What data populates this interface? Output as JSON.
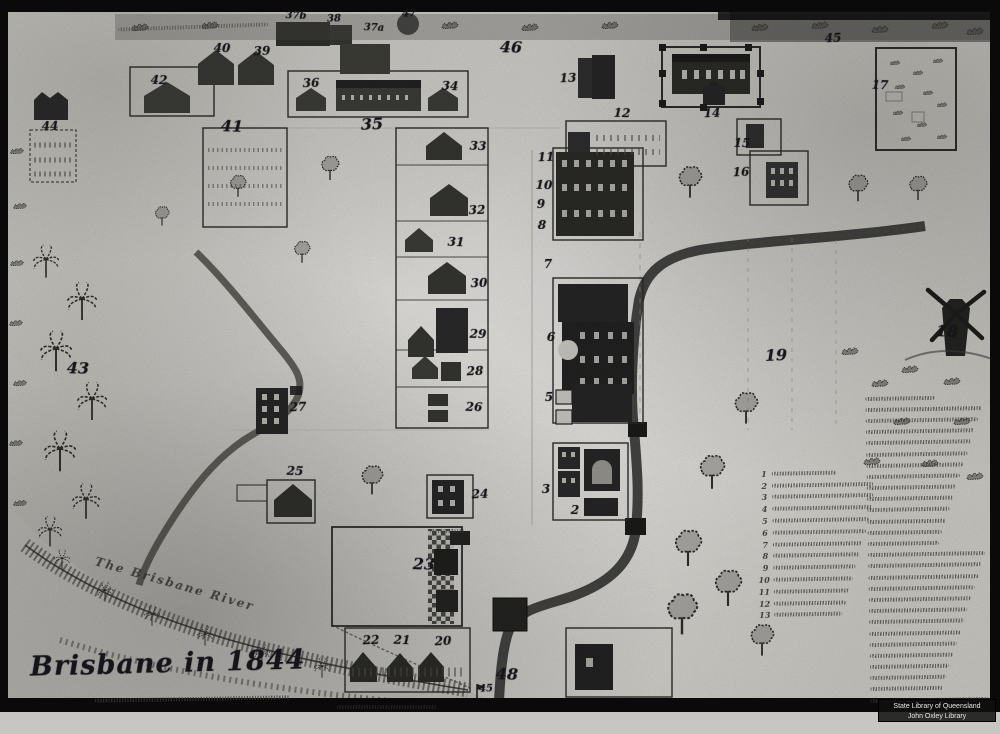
{
  "artwork": {
    "title": "Brisbane in 1844",
    "river_label": "The Brisbane River",
    "watermark": {
      "line1": "State Library of Queensland",
      "line2": "John Oxley Library"
    }
  },
  "markers": [
    {
      "n": "37b",
      "x": 296,
      "y": 16,
      "size": "sm"
    },
    {
      "n": "38",
      "x": 334,
      "y": 19,
      "size": "sm"
    },
    {
      "n": "37a",
      "x": 374,
      "y": 28,
      "size": "sm"
    },
    {
      "n": "47",
      "x": 409,
      "y": 14,
      "size": "sm"
    },
    {
      "n": "46",
      "x": 511,
      "y": 47,
      "size": "lg"
    },
    {
      "n": "45",
      "x": 833,
      "y": 38,
      "size": "md"
    },
    {
      "n": "40",
      "x": 222,
      "y": 48,
      "size": "md"
    },
    {
      "n": "39",
      "x": 262,
      "y": 51,
      "size": "md"
    },
    {
      "n": "42",
      "x": 159,
      "y": 80,
      "size": "md"
    },
    {
      "n": "36",
      "x": 311,
      "y": 83,
      "size": "md"
    },
    {
      "n": "34",
      "x": 450,
      "y": 86,
      "size": "md"
    },
    {
      "n": "35",
      "x": 372,
      "y": 124,
      "size": "lg"
    },
    {
      "n": "41",
      "x": 232,
      "y": 126,
      "size": "lg"
    },
    {
      "n": "44",
      "x": 50,
      "y": 126,
      "size": "md"
    },
    {
      "n": "43",
      "x": 78,
      "y": 368,
      "size": "lg"
    },
    {
      "n": "13",
      "x": 568,
      "y": 78,
      "size": "md"
    },
    {
      "n": "12",
      "x": 622,
      "y": 113,
      "size": "md"
    },
    {
      "n": "14",
      "x": 712,
      "y": 113,
      "size": "md"
    },
    {
      "n": "15",
      "x": 742,
      "y": 143,
      "size": "md"
    },
    {
      "n": "16",
      "x": 741,
      "y": 172,
      "size": "md"
    },
    {
      "n": "17",
      "x": 880,
      "y": 85,
      "size": "md"
    },
    {
      "n": "11",
      "x": 546,
      "y": 157,
      "size": "md"
    },
    {
      "n": "10",
      "x": 544,
      "y": 185,
      "size": "md"
    },
    {
      "n": "9",
      "x": 541,
      "y": 204,
      "size": "md"
    },
    {
      "n": "8",
      "x": 542,
      "y": 225,
      "size": "md"
    },
    {
      "n": "7",
      "x": 548,
      "y": 264,
      "size": "md"
    },
    {
      "n": "6",
      "x": 551,
      "y": 337,
      "size": "md"
    },
    {
      "n": "5",
      "x": 549,
      "y": 397,
      "size": "md"
    },
    {
      "n": "33",
      "x": 478,
      "y": 146,
      "size": "md"
    },
    {
      "n": "32",
      "x": 477,
      "y": 210,
      "size": "md"
    },
    {
      "n": "31",
      "x": 456,
      "y": 242,
      "size": "md"
    },
    {
      "n": "30",
      "x": 479,
      "y": 283,
      "size": "md"
    },
    {
      "n": "29",
      "x": 478,
      "y": 334,
      "size": "md"
    },
    {
      "n": "28",
      "x": 475,
      "y": 371,
      "size": "md"
    },
    {
      "n": "26",
      "x": 474,
      "y": 407,
      "size": "md"
    },
    {
      "n": "27",
      "x": 298,
      "y": 407,
      "size": "md"
    },
    {
      "n": "25",
      "x": 295,
      "y": 471,
      "size": "md"
    },
    {
      "n": "24",
      "x": 480,
      "y": 494,
      "size": "md"
    },
    {
      "n": "23",
      "x": 424,
      "y": 564,
      "size": "lg"
    },
    {
      "n": "3",
      "x": 546,
      "y": 489,
      "size": "md"
    },
    {
      "n": "2",
      "x": 575,
      "y": 510,
      "size": "md"
    },
    {
      "n": "19",
      "x": 776,
      "y": 355,
      "size": "lg"
    },
    {
      "n": "18",
      "x": 947,
      "y": 331,
      "size": "lg"
    },
    {
      "n": "22",
      "x": 371,
      "y": 640,
      "size": "md"
    },
    {
      "n": "21",
      "x": 402,
      "y": 640,
      "size": "md"
    },
    {
      "n": "20",
      "x": 443,
      "y": 641,
      "size": "md"
    },
    {
      "n": "48",
      "x": 507,
      "y": 674,
      "size": "lg"
    },
    {
      "n": "45",
      "x": 486,
      "y": 689,
      "size": "sm"
    }
  ],
  "legend": {
    "columns": [
      {
        "name": "left",
        "x": 758,
        "y": 467,
        "width": 116,
        "rows": 13,
        "row_h": 11.8,
        "numbered": true
      },
      {
        "name": "right",
        "x": 866,
        "y": 392,
        "width": 126,
        "rows": 28,
        "row_h": 11.2,
        "numbered": false
      }
    ]
  },
  "colors": {
    "paper": "#d3d1cb",
    "ink": "#1f1f1f",
    "frame": "#0a0a0a",
    "watermark_bg": "rgba(15,15,15,0.85)",
    "watermark_text": "#e6e6e6"
  }
}
